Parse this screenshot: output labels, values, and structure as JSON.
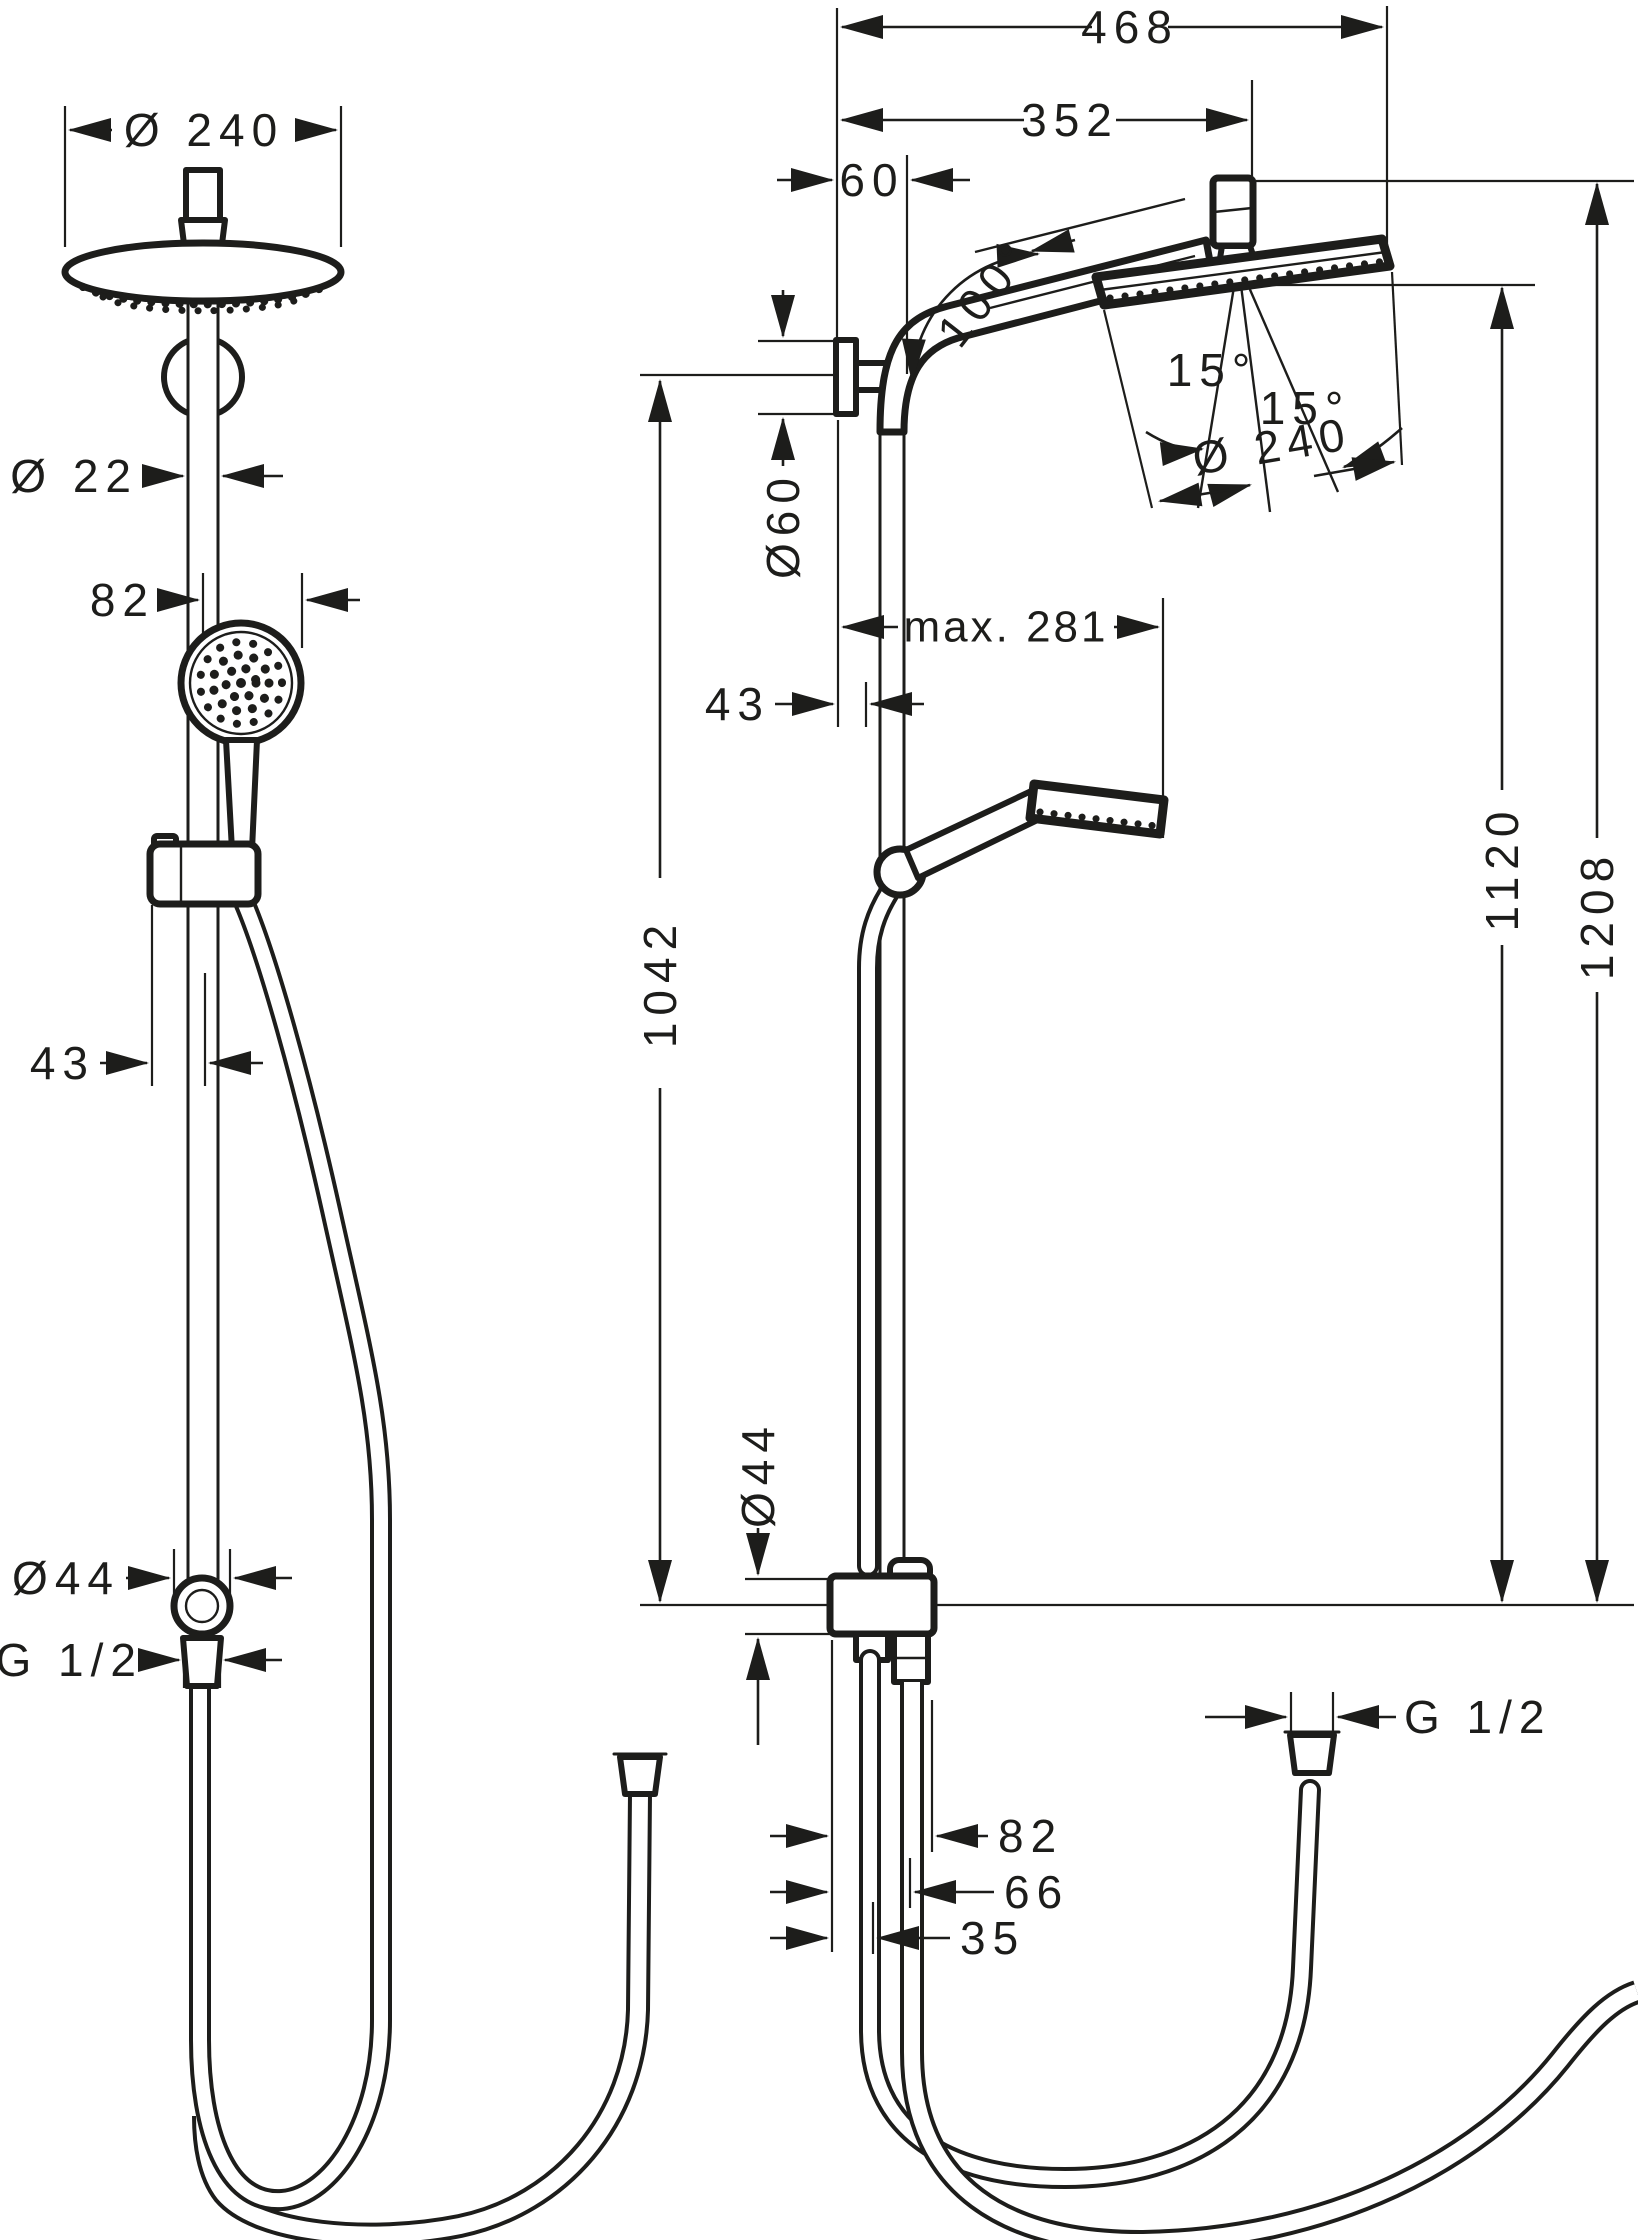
{
  "colors": {
    "ink": "#1d1d1b",
    "background": "#ffffff"
  },
  "views": {
    "front": {
      "labels": {
        "dia_head": "Ø 240",
        "dia_pipe": "Ø 22",
        "handshower_width": "82",
        "bracket_offset": "43",
        "dia_connector": "Ø44",
        "thread": "G 1/2"
      }
    },
    "side": {
      "labels": {
        "reach_total": "468",
        "reach_arm": "352",
        "offset_top": "60",
        "arm_angle": "100°",
        "tilt_left": "15°",
        "tilt_right": "15°",
        "dia_head": "Ø 240",
        "dia_escutcheon": "Ø60",
        "handshower_reach": "max. 281",
        "bracket_offset": "43",
        "height_bracket": "1042",
        "height_head_bottom": "1120",
        "height_head_top": "1208",
        "dia_connector": "Ø44",
        "thread": "G 1/2",
        "conn_width_outer": "82",
        "conn_width_mid": "66",
        "conn_width_inner": "35"
      }
    }
  }
}
